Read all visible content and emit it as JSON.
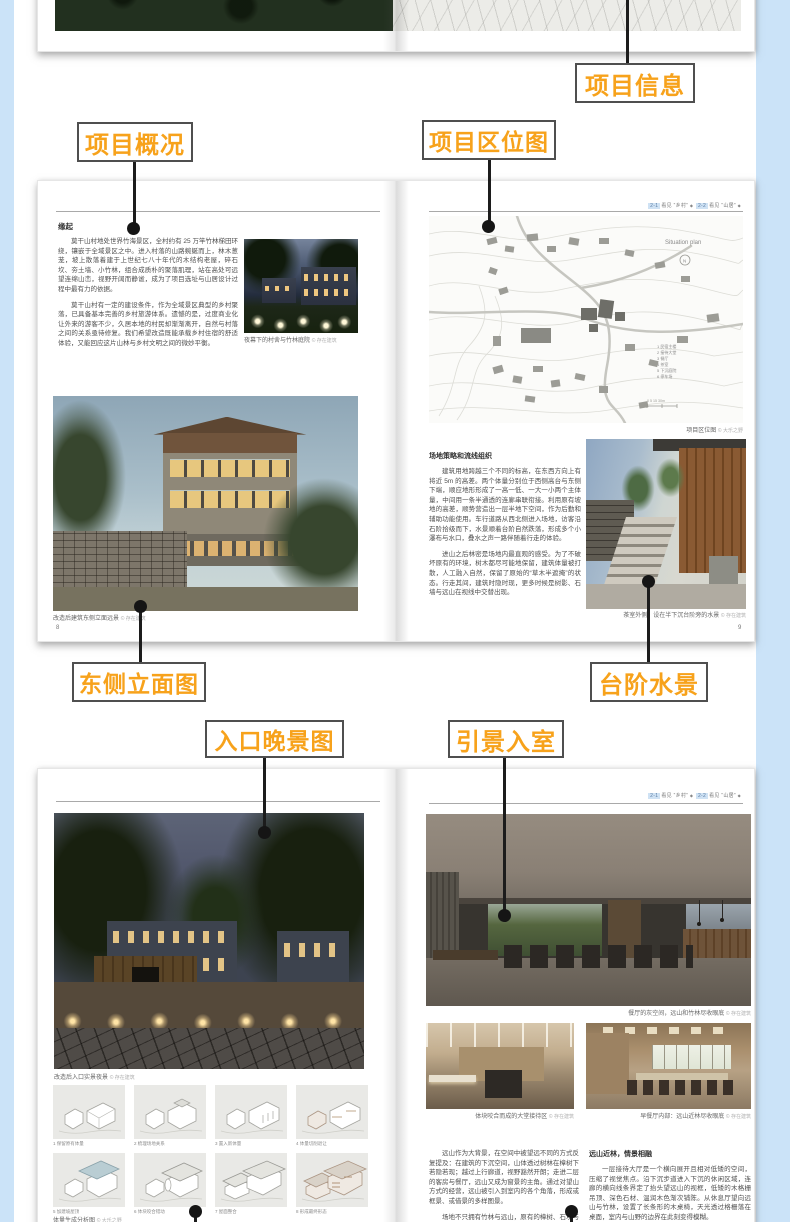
{
  "colors": {
    "accent": "#F7A21B",
    "callout_border": "#4f4f4f",
    "line": "#1c1c1c",
    "side_strip": "#cbe3f8"
  },
  "callouts": {
    "project_info": {
      "label": "项目信息"
    },
    "project_overview": {
      "label": "项目概况"
    },
    "project_location": {
      "label": "项目区位图"
    },
    "east_elevation": {
      "label": "东侧立面图"
    },
    "step_water": {
      "label": "台阶水景"
    },
    "entrance_night": {
      "label": "入口晚景图"
    },
    "scenery_into_room": {
      "label": "引景入室"
    }
  },
  "top_spread": {
    "forest_credit": "© 存在建筑"
  },
  "spread1": {
    "left": {
      "heading": "缘起",
      "para1": "莫干山村地处世界竹海景区，全村约有 25 万竿竹林梯田环绕，镶嵌于全域景区之中。进入村落的山路蜿蜒而上，林木葱茏，坡上散落着建于上世纪七八十年代的木结构老屋，碎石坎、夯土墙、小竹林，组合成质朴的聚落肌理，站在高处可远望连绵山峦，视野开阔而静谧，成为了项目选址与山居设计过程中最有力的依据。",
      "para2": "莫干山村有一定的建设条件，作为全域景区典型的乡村聚落，已具备基本完善的乡村旅游体系。遗憾的是，过度商业化让外来的游客不少，久居本地的村民却渐渐离开，自然与村落之间的关系亟待修复。我们希望改造既能承载乡村住宿的舒适体验，又能回应这片山林与乡村文明之间的微妙平衡。",
      "photo1_caption": "夜幕下的村舍与竹林庭院",
      "photo1_credit": "© 存在建筑",
      "photo2_caption": "改造后建筑东侧立面远景",
      "photo2_credit": "© 存在建筑",
      "page_no": "8"
    },
    "right": {
      "running_head": {
        "t1": "2-1",
        "l1": "看见 “乡村”",
        "t2": "2-2",
        "l2": "看见 “山居”",
        "d": "◆"
      },
      "map": {
        "title": "Situation plan",
        "north": "N",
        "legend": [
          "1 民宿主楼",
          "2 接待大堂",
          "3 餐厅",
          "4 茶室",
          "5 下沉庭院",
          "6 停车场"
        ],
        "scale": "0  5  15  30m",
        "caption": "项目区位图",
        "credit": "© 大乐之野"
      },
      "subheading": "场地策略和流线组织",
      "para1": "建筑用地跨越三个不同的标高，在东西方向上有将近 5m 的高差。两个体量分别位于西侧高台与东侧下端，顺应地形形成了一高一低、一大一小两个主体量，中间用一条半通透的连廊串联衔接。利用原有坡地的高差，顺势营造出一层半地下空间，作为后勤和辅助功能使用。车行道路从西北侧进入场地，访客沿石阶拾级而下，水景顺着台阶自然跌落，形成多个小瀑布与水口，叠水之声一路伴随着行走的体验。",
      "para2": "进山之后林密是场地内最直观的感受。为了不破坏原有的环境，树木都尽可能地保留，建筑体量被打散，人工融入自然，保留了原始的“草木半遮掩”的状态。行走其间，建筑时隐时现，更多时候是树影、石墙与远山在视线中交替出现。",
      "photo_caption": "茶室外侧：设在半下沉台阶旁的水景",
      "photo_credit": "© 存在建筑",
      "page_no": "9"
    }
  },
  "spread2": {
    "left": {
      "photo_caption": "改造后入口实景夜景",
      "photo_credit": "© 存在建筑",
      "diagrams": [
        "1 保留原有体量",
        "2 梳理场地关系",
        "3 置入新体量",
        "4 体量切削退让",
        "5 加建坡屋顶",
        "6 体块咬合错动",
        "7 屋面整合",
        "8 形成最终形态"
      ],
      "grid_caption": "体量生成分析图",
      "grid_credit": "© 大乐之野"
    },
    "right": {
      "running_head": {
        "t1": "2-1",
        "l1": "看见 “乡村”",
        "t2": "2-2",
        "l2": "看见 “山居”",
        "d": "◆"
      },
      "photo_main_caption": "餐厅的灰空间，远山和竹林尽收眼底",
      "photo_main_credit": "© 存在建筑",
      "photo_a_caption": "体块咬合而成的大堂接待区",
      "photo_a_credit": "© 存在建筑",
      "photo_b_caption": "早餐厅内部：远山近林尽收眼底",
      "photo_b_credit": "© 存在建筑",
      "col1_para1": "远山作为大背景，在空间中被望远不同的方式反复提及：在建筑的下沉空间，山体透过树林在樟树下若隐若现；越过上行廊道，视野豁然开朗；走进二层的客房与餐厅，远山又成为窗景的主角。通过对望山方式的经营，远山被引入到室内的各个角落，形成或框景、或借景的多样图景。",
      "col1_para2": "场地不只拥有竹林与远山，原有的樟树、石坎与溪流，连同山风一起构成记忆。我们用竹林修复场地的每一处边界，人融入其中，建筑的空间和视野也因此变得具体。",
      "subheading": "远山近林，情景相融",
      "col2_para1": "一层接待大厅是一个横向展开且相对低矮的空间，压缩了视觉焦点。沿下沉步道进入下沉的休闲区域，连廊的横向线条界定了抬头望远山的视框，低矮的木格栅吊顶、深色石材、温润木色渐次铺陈。从休息厅望向远山与竹林，设置了长条形的木桌椅，天光透过格栅落在桌面，室内与山野的边界在此刻变得模糊。"
    }
  }
}
